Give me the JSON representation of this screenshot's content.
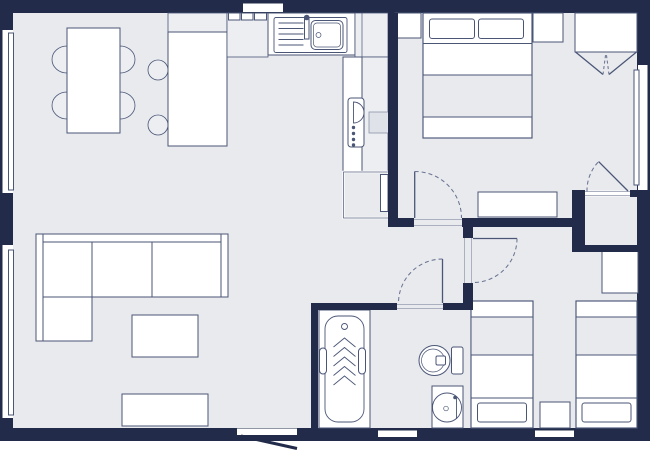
{
  "colors": {
    "wall": "#222c4a",
    "floor": "#e8eaee",
    "furniture": "#ffffff",
    "outline": "#4b5677",
    "soft": "#eceef2",
    "dashed": "#6b7492",
    "threshold": "#aab0c0",
    "hatch": "#dfe2e8",
    "hatch_border": "#8d94a8",
    "background": "#ffffff"
  },
  "floorplan": {
    "type": "apartment-floor-plan",
    "rooms": [
      {
        "name": "living-dining-room",
        "furniture": [
          "dining-table",
          "dining-chair",
          "dining-chair",
          "dining-chair",
          "dining-chair",
          "kitchen-island",
          "bar-stool",
          "bar-stool",
          "corner-sofa",
          "coffee-table",
          "tv-sideboard"
        ],
        "windows": [
          "left-window-upper",
          "left-window-lower"
        ]
      },
      {
        "name": "kitchen",
        "furniture": [
          "sink-with-drainboard",
          "faucet",
          "cooktop-counter",
          "corner-counter",
          "oven-with-knobs",
          "built-in-appliance",
          "base-cabinet",
          "wall-counter"
        ]
      },
      {
        "name": "bedroom-1",
        "furniture": [
          "double-bed",
          "pillow",
          "pillow",
          "nightstand-left",
          "nightstand-right",
          "wardrobe-open-doors",
          "dresser"
        ],
        "windows": [
          "right-window"
        ],
        "doors": [
          "hinged-door-to-hall",
          "hinged-door-to-closet"
        ]
      },
      {
        "name": "closet",
        "furniture": []
      },
      {
        "name": "bedroom-2",
        "furniture": [
          "single-bed",
          "single-bed",
          "pillow",
          "pillow",
          "nightstand",
          "corner-cabinet"
        ],
        "doors": [
          "hinged-door-to-hall"
        ]
      },
      {
        "name": "bathroom",
        "furniture": [
          "bathtub",
          "grab-bar",
          "grab-bar",
          "toilet",
          "vanity-basin"
        ],
        "doors": [
          "hinged-door-to-hall"
        ]
      },
      {
        "name": "hallway",
        "furniture": []
      }
    ],
    "openings": {
      "entrance_door": "bottom-wall",
      "wall_vents": [
        "top-wall",
        "bottom-wall-under-bathroom",
        "bottom-wall-under-bedroom-2"
      ],
      "window_count": 3
    }
  }
}
